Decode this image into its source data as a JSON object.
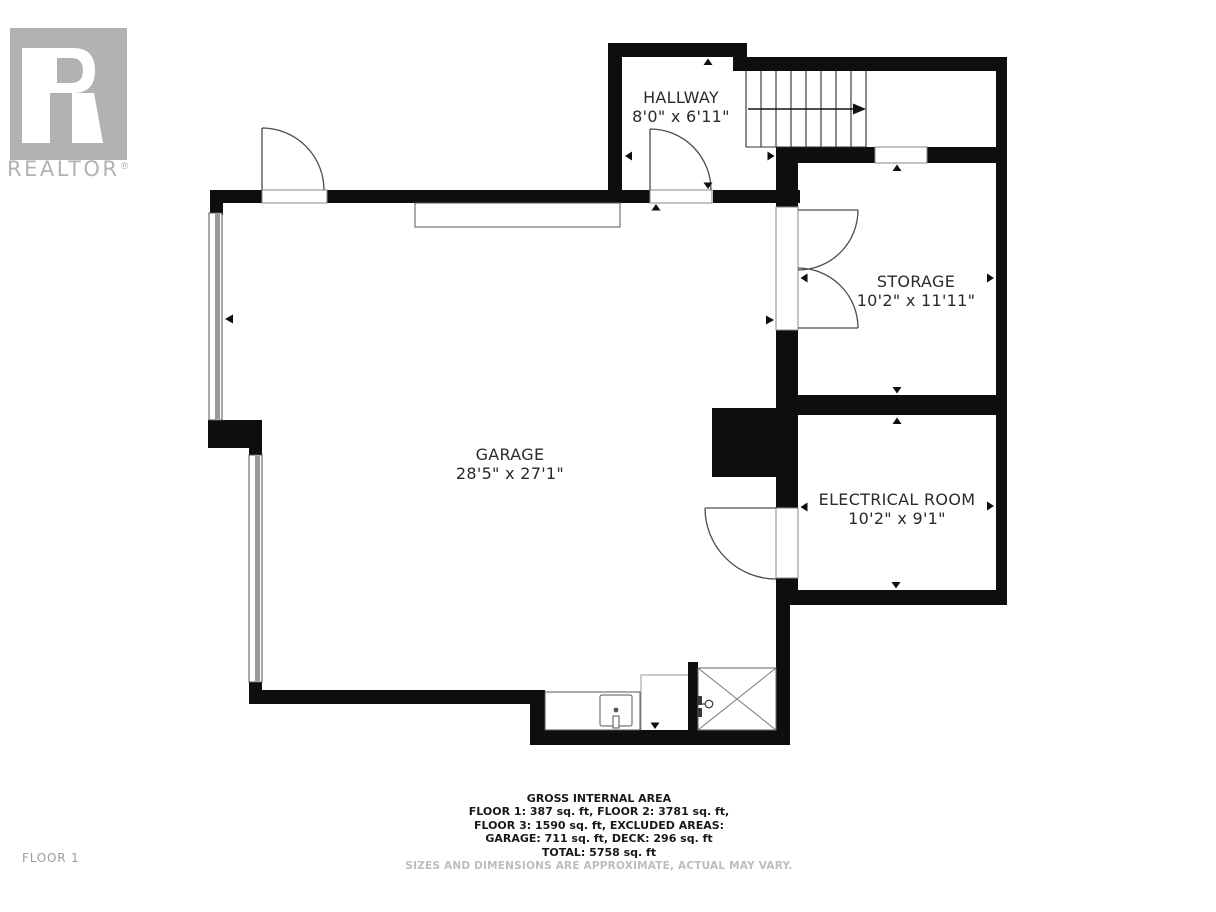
{
  "branding": {
    "name": "REALTOR",
    "reg": "®"
  },
  "floor_label": "FLOOR 1",
  "rooms": {
    "hallway": {
      "name": "HALLWAY",
      "dims": "8'0\" x 6'11\""
    },
    "storage": {
      "name": "STORAGE",
      "dims": "10'2\" x 11'11\""
    },
    "garage": {
      "name": "GARAGE",
      "dims": "28'5\" x 27'1\""
    },
    "electrical": {
      "name": "ELECTRICAL ROOM",
      "dims": "10'2\" x 9'1\""
    }
  },
  "footer": {
    "title": "GROSS INTERNAL AREA",
    "lines": [
      "FLOOR 1: 387 sq. ft, FLOOR 2: 3781 sq. ft,",
      "FLOOR 3: 1590 sq. ft, EXCLUDED AREAS:",
      "GARAGE: 711 sq. ft, DECK: 296 sq. ft",
      "TOTAL: 5758 sq. ft"
    ],
    "disclaimer": "SIZES AND DIMENSIONS ARE APPROXIMATE, ACTUAL MAY VARY."
  },
  "colors": {
    "wall": "#0e0e0e",
    "thin_line": "#4d4d4d",
    "window_glass": "#9a9a9a",
    "logo_gray": "#b3b2b2",
    "disclaimer_gray": "#bdbdbd",
    "floor_label_gray": "#9d9d9d",
    "background": "#ffffff"
  }
}
